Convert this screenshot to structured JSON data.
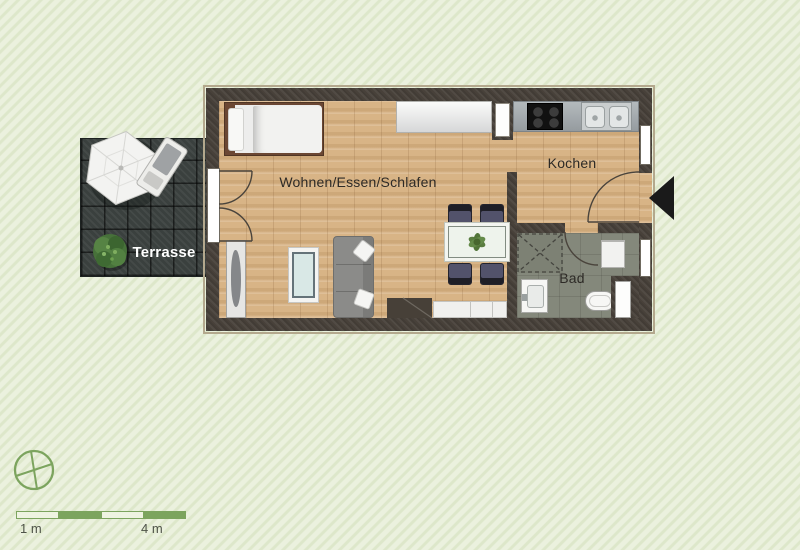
{
  "rooms": {
    "living": {
      "label": "Wohnen/Essen/Schlafen"
    },
    "kitchen": {
      "label": "Kochen"
    },
    "bath": {
      "label": "Bad"
    },
    "terrace": {
      "label": "Terrasse"
    }
  },
  "scale_bar": {
    "left_label": "1 m",
    "right_label": "4 m",
    "segment_count": 4,
    "total_meters": 4
  },
  "colors": {
    "background": "#e9efdc",
    "background_stripe": "#dde7ca",
    "wall": "#48413a",
    "wood_floor": "#d8b486",
    "bath_floor": "#84887b",
    "terrace_tile": "#3a403e",
    "kitchen_counter": "#a9afb3",
    "scale_green": "#7ca45e",
    "label_text": "#2d2a26",
    "terrace_label_text": "#ffffff",
    "entrance_arrow": "#1a1a1a"
  },
  "icons": {
    "compass": "compass-icon",
    "entrance_arrow": "entrance-arrow-icon",
    "parasol": "parasol-icon",
    "terrace_plant": "plant-icon",
    "table_plant": "plant-icon"
  },
  "furniture": {
    "living": [
      "bed",
      "sideboard",
      "wardrobe",
      "coffee-table",
      "sofa",
      "dining-table",
      "dining-chairs",
      "bench",
      "duct"
    ],
    "kitchen": [
      "counter",
      "cooktop",
      "double-sink",
      "tall-cabinet"
    ],
    "bath": [
      "shower",
      "washbasin",
      "toilet",
      "washing-machine"
    ],
    "terrace": [
      "parasol",
      "lounge-chair",
      "plant"
    ]
  }
}
